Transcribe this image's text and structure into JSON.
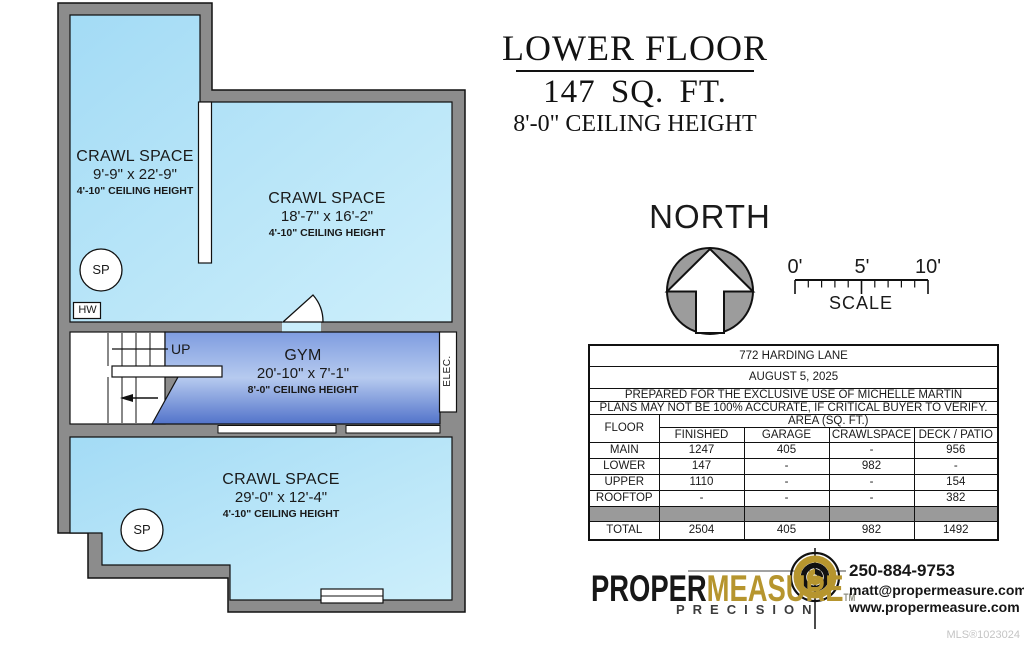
{
  "title": {
    "line1": "LOWER FLOOR",
    "line2": "147  SQ. FT.",
    "line3": "8'-0\" CEILING HEIGHT"
  },
  "north_label": "NORTH",
  "scale_bar": {
    "tick0": "0'",
    "tick5": "5'",
    "tick10": "10'",
    "label": "SCALE"
  },
  "rooms": [
    {
      "name": "CRAWL SPACE",
      "dims": "9'-9\" x 22'-9\"",
      "ceiling": "4'-10\" CEILING HEIGHT"
    },
    {
      "name": "CRAWL SPACE",
      "dims": "18'-7\" x 16'-2\"",
      "ceiling": "4'-10\" CEILING HEIGHT"
    },
    {
      "name": "GYM",
      "dims": "20'-10\" x 7'-1\"",
      "ceiling": "8'-0\" CEILING HEIGHT"
    },
    {
      "name": "CRAWL SPACE",
      "dims": "29'-0\" x 12'-4\"",
      "ceiling": "4'-10\" CEILING HEIGHT"
    }
  ],
  "plan_labels": {
    "up": "UP",
    "hw": "HW",
    "sp": "SP",
    "elec": "ELEC."
  },
  "info_table": {
    "address": "772 HARDING LANE",
    "date": "AUGUST 5, 2025",
    "prepared": "PREPARED FOR THE EXCLUSIVE USE OF MICHELLE MARTIN",
    "disclaimer": "PLANS MAY NOT BE 100% ACCURATE, IF CRITICAL BUYER TO VERIFY.",
    "floor_header": "FLOOR",
    "area_header": "AREA (SQ. FT.)",
    "columns": [
      "FINISHED",
      "GARAGE",
      "CRAWLSPACE",
      "DECK / PATIO"
    ],
    "rows": [
      {
        "floor": "MAIN",
        "values": [
          "1247",
          "405",
          "-",
          "956"
        ]
      },
      {
        "floor": "LOWER",
        "values": [
          "147",
          "-",
          "982",
          "-"
        ]
      },
      {
        "floor": "UPPER",
        "values": [
          "1110",
          "-",
          "-",
          "154"
        ]
      },
      {
        "floor": "ROOFTOP",
        "values": [
          "-",
          "-",
          "-",
          "382"
        ]
      },
      {
        "floor": "TOTAL",
        "values": [
          "2504",
          "405",
          "982",
          "1492"
        ]
      }
    ]
  },
  "branding": {
    "brand_part1": "PROPER",
    "brand_part2": "MEASURE",
    "trademark": "TM",
    "tagline": "PRECISION",
    "phone": "250-884-9753",
    "email": "matt@propermeasure.com",
    "website": "www.propermeasure.com",
    "brand_gold": "#b6952e"
  },
  "footer": {
    "mls": "MLS®1023024"
  },
  "colors": {
    "crawl_space_fill": "#b5e3f7",
    "gym_fill": "#7f9ce0",
    "wall_gray": "#8c8c8c"
  }
}
